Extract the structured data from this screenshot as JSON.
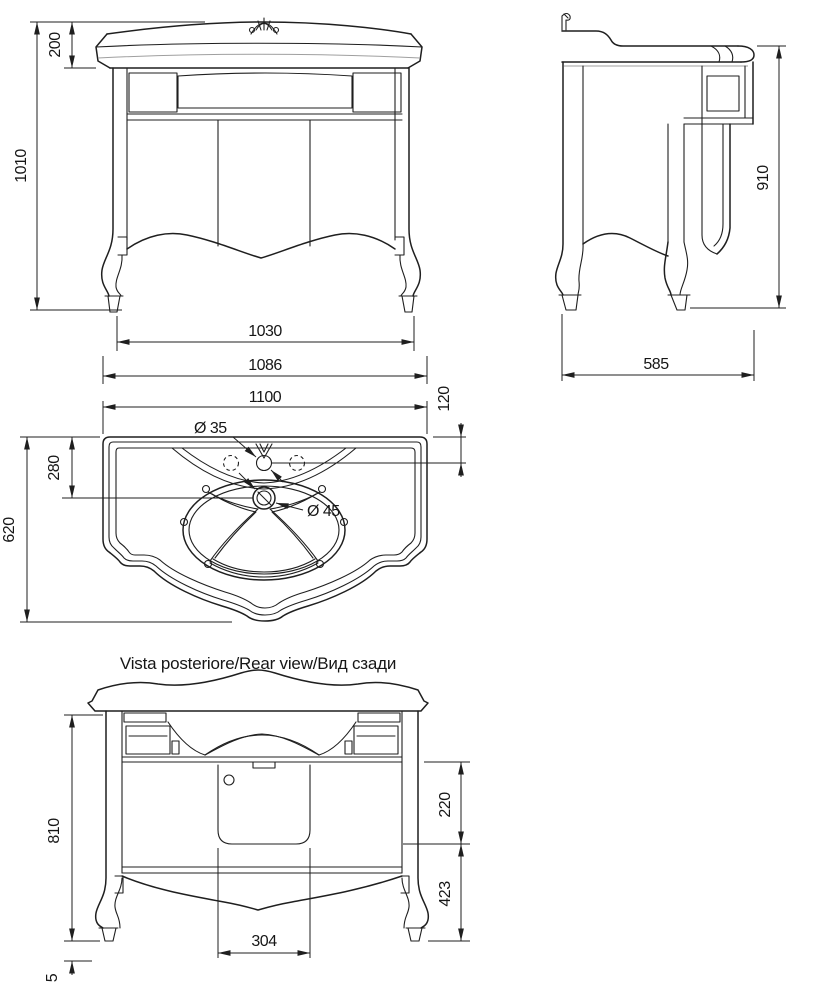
{
  "drawing": {
    "line_color": "#1f1f1f",
    "background": "#ffffff",
    "front_view": {
      "dim_countertop_height": "200",
      "dim_total_height": "1010",
      "dim_feet_span": "1030",
      "dim_overall_width": "1086"
    },
    "side_view": {
      "dim_cabinet_height": "910",
      "dim_depth": "585"
    },
    "top_view": {
      "dim_width": "1100",
      "dim_faucet_offset": "120",
      "dim_drain_offset": "280",
      "dim_depth": "620",
      "dim_faucet_hole": "Ø 35",
      "dim_drain_hole": "Ø 45"
    },
    "rear_view": {
      "title": "Vista posteriore/Rear view/Вид сзади",
      "dim_height": "810",
      "dim_foot_adjust": "5",
      "dim_panel_height": "220",
      "dim_lower_height": "423",
      "dim_panel_width": "304"
    }
  }
}
